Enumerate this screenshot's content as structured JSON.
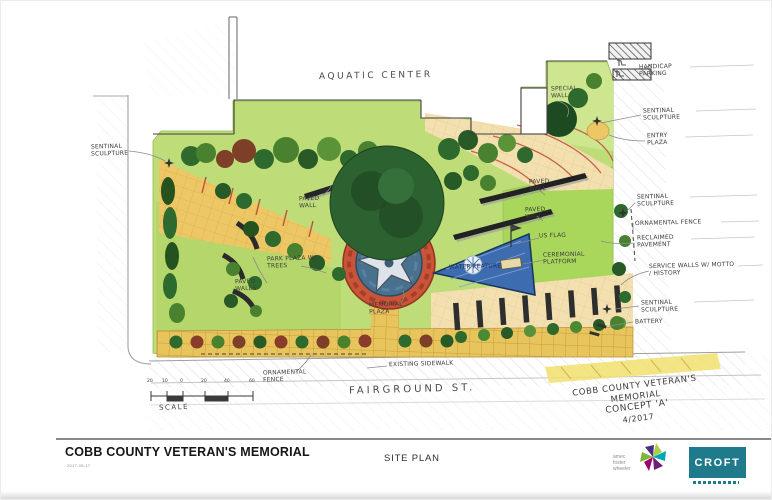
{
  "sheet": {
    "project_title": "COBB COUNTY VETERAN'S MEMORIAL",
    "date_stamp": "2017-05-17",
    "sheet_name": "SITE PLAN",
    "amec_logo_lines": [
      "amec",
      "foster",
      "wheeler"
    ],
    "croft_logo_text": "CROFT"
  },
  "plan": {
    "building_label": "AQUATIC CENTER",
    "street_label": "FAIRGROUND ST.",
    "scale": {
      "label": "SCALE",
      "ticks": [
        "20",
        "10",
        "0",
        "20",
        "40",
        "60"
      ]
    },
    "concept_lines": [
      "COBB COUNTY VETERAN'S",
      "MEMORIAL",
      "CONCEPT 'A'",
      "4/2017"
    ],
    "annotations": [
      {
        "id": "sentinal-sculpture-w",
        "text": "SENTINAL SCULPTURE"
      },
      {
        "id": "special-wall",
        "text": "SPECIAL WALL"
      },
      {
        "id": "handicap-parking",
        "text": "HANDICAP PARKING"
      },
      {
        "id": "sentinal-sculpture-ne",
        "text": "SENTINAL SCULPTURE"
      },
      {
        "id": "entry-plaza",
        "text": "ENTRY PLAZA"
      },
      {
        "id": "sentinal-sculpture-e",
        "text": "SENTINAL SCULPTURE"
      },
      {
        "id": "ornamental-fence-e",
        "text": "ORNAMENTAL FENCE"
      },
      {
        "id": "reclaimed-pavement",
        "text": "RECLAIMED PAVEMENT"
      },
      {
        "id": "service-walls",
        "text": "SERVICE WALLS W/ MOTTO / HISTORY"
      },
      {
        "id": "sentinal-sculpture-se",
        "text": "SENTINAL SCULPTURE"
      },
      {
        "id": "battery",
        "text": "BATTERY"
      },
      {
        "id": "paved-wall-nw",
        "text": "PAVED WALL"
      },
      {
        "id": "park-plaza",
        "text": "PARK PLAZA W/ TREES"
      },
      {
        "id": "paved-walls-w",
        "text": "PAVED WALLS"
      },
      {
        "id": "paved-wall-ne1",
        "text": "PAVED WALL"
      },
      {
        "id": "paved-wall-ne2",
        "text": "PAVED WALL"
      },
      {
        "id": "us-flag",
        "text": "US FLAG"
      },
      {
        "id": "ceremonial-platform",
        "text": "CEREMONIAL PLATFORM"
      },
      {
        "id": "water-feature",
        "text": "WATER FEATURE"
      },
      {
        "id": "memorial-plaza",
        "text": "MEMORIAL PLAZA"
      },
      {
        "id": "ornamental-fence-s",
        "text": "ORNAMENTAL FENCE"
      },
      {
        "id": "existing-sidewalk",
        "text": "EXISTING SIDEWALK"
      }
    ],
    "colors": {
      "lawn": "#bedc78",
      "paving_tan": "#ecc764",
      "memorial_ring_red": "#c8543a",
      "memorial_core_blue": "#49718e",
      "water_blue": "#3e6cb0",
      "croft_teal": "#1f7b8b"
    }
  }
}
